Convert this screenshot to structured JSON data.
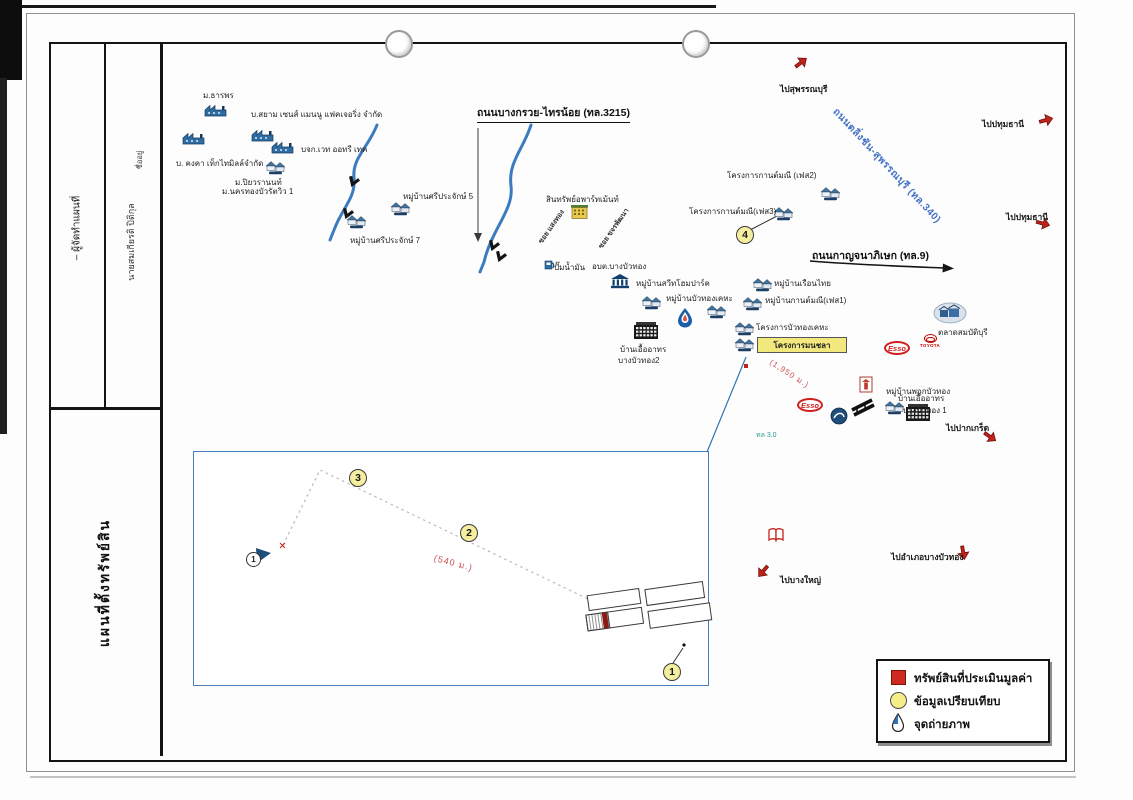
{
  "colors": {
    "road_blue": "#4472c4",
    "canal_blue": "#3b7bbf",
    "marker_yellow": "#f5ee9e",
    "arrow_red": "#c0231c",
    "legend_red": "#cf2a1f",
    "subject_yellow": "#f3e87e"
  },
  "titleblock": {
    "field1": "– ผู้จัดทำแผนที่",
    "field2_small": "ชื่ออยู่",
    "field2": "นายสมเกียรติ ปิติกุล",
    "map_title": "แผนที่ตั้งทรัพย์สิน"
  },
  "roads": {
    "r3215": "ถนนบางกรวย-ไทรน้อย (ทล.3215)",
    "r9": "ถนนกาญจนาภิเษก (ทล.9)",
    "r340": "ถนนตลิ่งชัน-สุพรรณบุรี (ทล.340)",
    "soi1": "ซอย แสงทอง",
    "soi2": "ซอย ขจรพัฒนา",
    "hw_note": "ทล 3.0"
  },
  "directions": {
    "suphan": "ไปสุพรรณบุรี",
    "pathum1": "ไปปทุมธานี",
    "pathum2": "ไปปทุมธานี",
    "pakkret": "ไปปากเกร็ด",
    "amphoe_bbt": "ไปอำเภอบางบัวทอง",
    "bangyai": "ไปบางใหญ่"
  },
  "labels": {
    "tharnporn": "ม.ธารพร",
    "siam": "บ.สยาม เซนส์ แมนนู แฟคเจอริ่ง จำกัด",
    "wet_autori": "บจก.เวท ออทรี เทค",
    "kongka": "บ. คงคา เท็กไทมิลล์จำกัด",
    "piyawara": "ม.ปิยวรานนท์",
    "nakhonthong": "ม.นครทองบัวรัตวิว 1",
    "sriprajak5": "หมู่บ้านศรีประจักษ์ 5",
    "sriprajak7": "หมู่บ้านศรีประจักษ์ 7",
    "sintharap": "สินทรัพย์อพาร์ทเม้นท์",
    "gas": "ปั๊มน้ำมัน",
    "obt": "อบต.บางบัวทอง",
    "sweethome": "หมู่บ้านสวีทโฮมปาร์ค",
    "buathong_kheha": "หมู่บ้านบัวทองเคหะ",
    "uea2a": "บ้านเอื้ออาทร",
    "uea2b": "บางบัวทอง2",
    "buathong_project": "โครงการบัวทองเคหะ",
    "ruenthai": "หมู่บ้านเรือนไทย",
    "kanmanee1": "หมู่บ้านกานต์มณี(เฟส1)",
    "kanmanee2": "โครงการกานต์มณี (เฟส2)",
    "kanmanee3": "โครงการกานต์มณี(เฟส3)",
    "talad": "ตลาดสมบัติบุรี",
    "pruek": "หมู่บ้านพฤกบัวทอง",
    "uea1a": "บ้านเอื้ออาทร",
    "uea1b": "บางบัวทอง 1"
  },
  "subject": {
    "name": "โครงการมนชลา"
  },
  "distances": {
    "d_main": "(1,950 ม.)",
    "d_inset": "(540 ม.)"
  },
  "markers": {
    "map4": "4",
    "inset1": "1",
    "inset2": "2",
    "inset3": "3",
    "photo1": "1"
  },
  "legend": {
    "item1": "ทรัพย์สินที่ประเมินมูลค่า",
    "item2": "ข้อมูลเปรียบเทียบ",
    "item3": "จุดถ่ายภาพ"
  },
  "logos": {
    "esso": "Esso",
    "toyota": "TOYOTA"
  }
}
